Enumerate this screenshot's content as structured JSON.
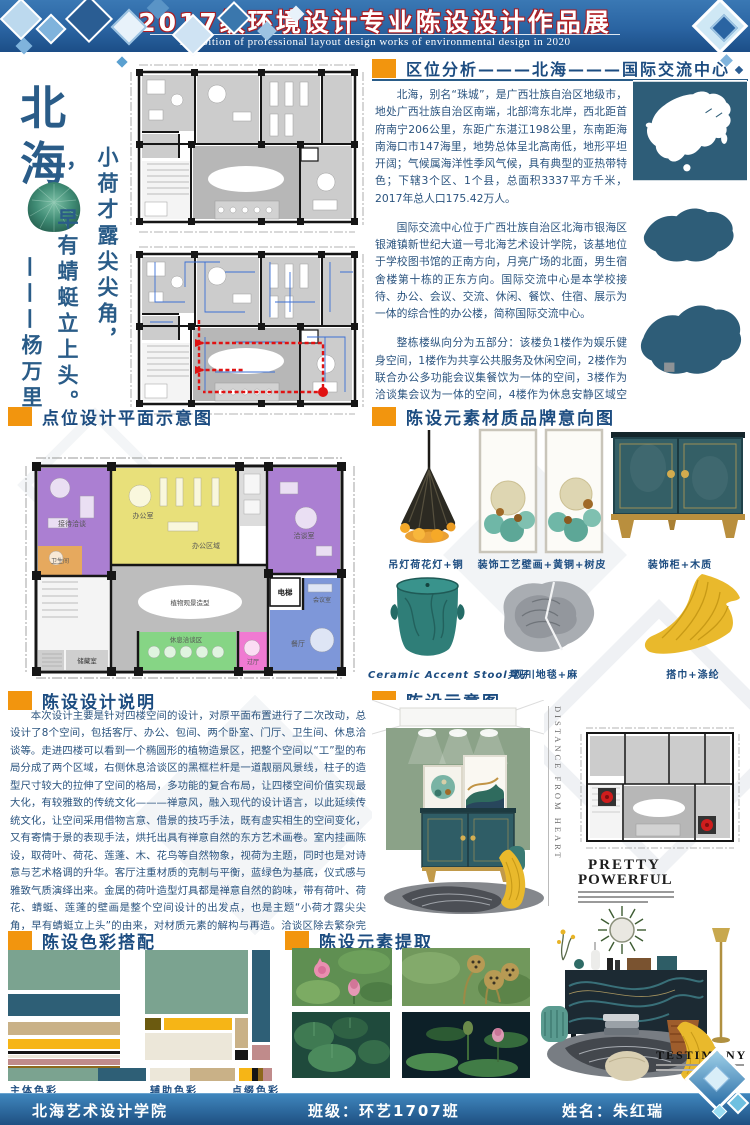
{
  "header": {
    "title": "2017级环境设计专业陈设设计作品展",
    "subtitle": "Exhibition of professional layout design works of environmental design in 2020"
  },
  "left_panel": {
    "city_char1": "北",
    "city_char2": "海",
    "comma": "，",
    "poem": [
      "小荷才露尖尖角，",
      "早有蜻蜓立上头。",
      "———杨万里"
    ]
  },
  "location": {
    "title": "区位分析———北海———国际交流中心",
    "p1": "北海，别名“珠城”，是广西壮族自治区地级市，地处广西壮族自治区南端，北部湾东北岸，西北距首府南宁206公里，东距广东湛江198公里，东南距海南海口市147海里，地势总体呈北高南低，地形平坦开阔；气候属海洋性季风气候，具有典型的亚热带特色；下辖3个区、1个县，总面积3337平方千米，2017年总人口175.42万人。",
    "p2": "国际交流中心位于广西壮族自治区北海市银海区银滩镇新世纪大道一号北海艺术设计学院，该基地位于学校图书馆的正南方向，月亮广场的北面，男生宿舍楼第十栋的正东方向。国际交流中心是本学校接待、办公、会议、交流、休闲、餐饮、住宿、展示为一体的综合性的办公楼，简称国际交流中心。",
    "p3": "整栋楼纵向分为五部分：该楼负1楼作为娱乐健身空间，1楼作为共享公共服务及休闲空间，2楼作为联合办公多功能会议集餐饮为一体的空间，3楼作为洽谈集会议为一体的空间，4楼作为休息安静区域空间。"
  },
  "plan_section": {
    "title": "点位设计平面示意图",
    "labels": {
      "reception": "接待洽谈",
      "wc": "卫生间",
      "office": "办公室",
      "office_area": "办公区域",
      "talk": "洽谈室",
      "meeting": "会议室",
      "dining": "餐厅",
      "hall": "过厅",
      "rest": "休息洽谈区",
      "elevator": "电梯",
      "storage": "储藏室",
      "feature": "植物观景造型"
    }
  },
  "materials": {
    "title": "陈设元素材质品牌意向图",
    "items": [
      {
        "caption": "吊灯荷花灯+铜"
      },
      {
        "caption": "装饰工艺壁画+黄铜+树皮"
      },
      {
        "caption": "装饰柜+木质"
      },
      {
        "caption": "Ceramic Accent Stool凳子"
      },
      {
        "caption": "观川地毯+麻"
      },
      {
        "caption": "搭巾+涤纶"
      }
    ]
  },
  "design_notes": {
    "title": "陈设设计说明",
    "text": "本次设计主要是针对四楼空间的设计，对原平面布置进行了二次改动，总设计了8个空间，包括客厅、办公、包间、两个卧室、门厅、卫生间、休息洽谈等。走进四楼可以看到一个椭圆形的植物造景区，把整个空间以“工”型的布局分成了两个区域，右侧休息洽谈区的黑框栏杆是一道靓丽风景线，柱子的造型尺寸较大的拉伸了空间的格局，多功能的复合布局，让四楼空间价值实现最大化，有较雅致的传统文化———禅意风，融入现代的设计语言，以此延续传统文化，让空间采用借物言意、借景的技巧手法，既有虚实相生的空间变化，又有寄情于景的表现手法，烘托出具有禅意自然的东方艺术画卷。室内挂画陈设，取荷叶、荷花、莲蓬、木、花鸟等自然物象，视荷为主题，同时也是对诗意与艺术格调的升华。客厅注重材质的克制与平衡，蓝绿色为基底，仪式感与雅致气质演绎出来。金属的荷叶造型灯具都是禅意自然的韵味，带有荷叶、荷花、蜻蜓、莲蓬的壁画是整个空间设计的出发点，也是主题“小荷才露尖尖角，早有蜻蜓立上头”的由来，对材质元素的解构与再造。洽谈区除去繁杂完全的陈搭，以奇趣搭配彰显大气，立面黑框色立柱，粉红和蓝的挂画，配合蓝色沙发、木质茶几案、年轮纹地毯，演绎出雅致又大气沉稳的格调，粉红色花和黄色花朵的点缀缓和氛围，展现出轻快写意的洽谈场景。整个空间以蓝绿色为主色调，黄色、米白、粉红为辅助色的陈设，适宜的比例，实现多样元素的碰撞演绎，错落有序、层次丰富，既有传统又有现代元素，结合多样材质风格，展现出多样的情趣。"
  },
  "display": {
    "title": "陈设示意图",
    "wall_text": "DISTANCE FROM HEART",
    "magazine_line1": "PRETTY",
    "magazine_line2": "POWERFUL"
  },
  "colors_section": {
    "title": "陈设色彩搭配",
    "labels": [
      "主体色彩",
      "辅助色彩",
      "点缀色彩"
    ],
    "palette": {
      "sage": "#7ba390",
      "teal": "#2e5f76",
      "tan": "#c9b187",
      "yellow": "#f6b516",
      "black": "#151515",
      "cream": "#ece7d9",
      "rose": "#c08b8b",
      "brown": "#8d681d",
      "olive": "#6b5a10"
    }
  },
  "elements_section": {
    "title": "陈设元素提取"
  },
  "montage": {
    "title": "TESTIMONY"
  },
  "footer": {
    "school": "北海艺术设计学院",
    "class_label": "班级：环艺1707班",
    "name_label": "姓名：朱红瑞"
  }
}
